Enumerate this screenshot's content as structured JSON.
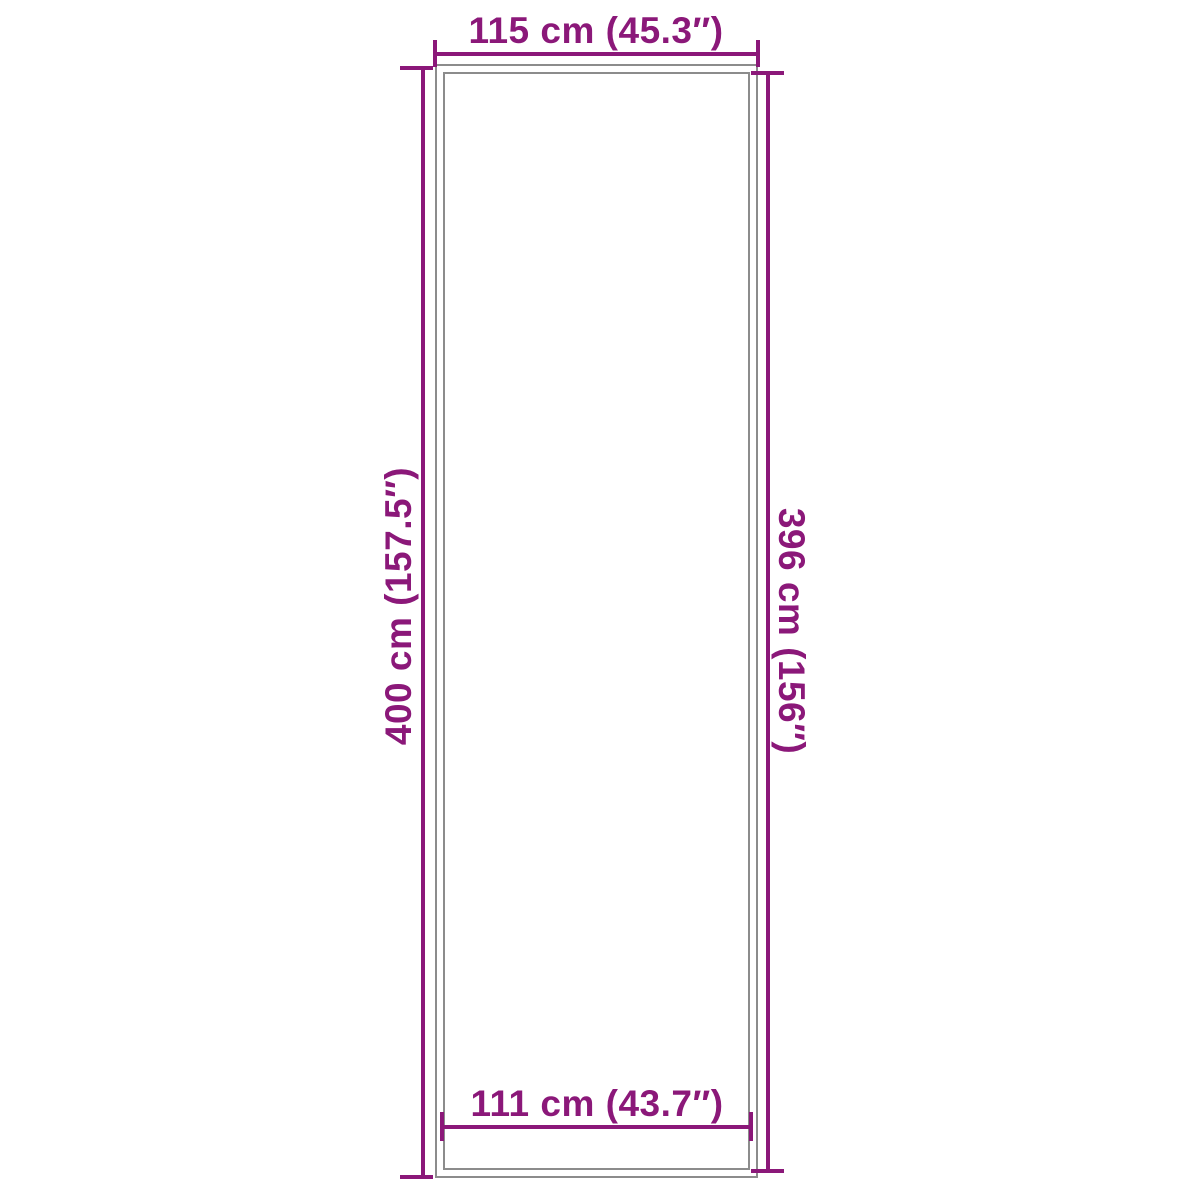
{
  "diagram": {
    "type": "product-dimension-drawing",
    "shape": "rectangle-double-outline",
    "background_color": "#ffffff",
    "outline_color": "#8c8c8c",
    "dimension_color": "#8b1879",
    "dimensions": {
      "top_width": {
        "label": "115 cm (45.3″)",
        "value_cm": "115",
        "value_inches": "45.3",
        "position": "top-outside"
      },
      "bottom_inner_width": {
        "label": "111 cm (43.7″)",
        "value_cm": "111",
        "value_inches": "43.7",
        "position": "bottom-inside"
      },
      "left_height": {
        "label": "400 cm (157.5″)",
        "value_cm": "400",
        "value_inches": "157.5",
        "position": "left-outside",
        "text_direction": "bottom-to-top"
      },
      "right_height": {
        "label": "396 cm (156″)",
        "value_cm": "396",
        "value_inches": "156",
        "position": "right-outside",
        "text_direction": "top-to-bottom"
      }
    }
  }
}
